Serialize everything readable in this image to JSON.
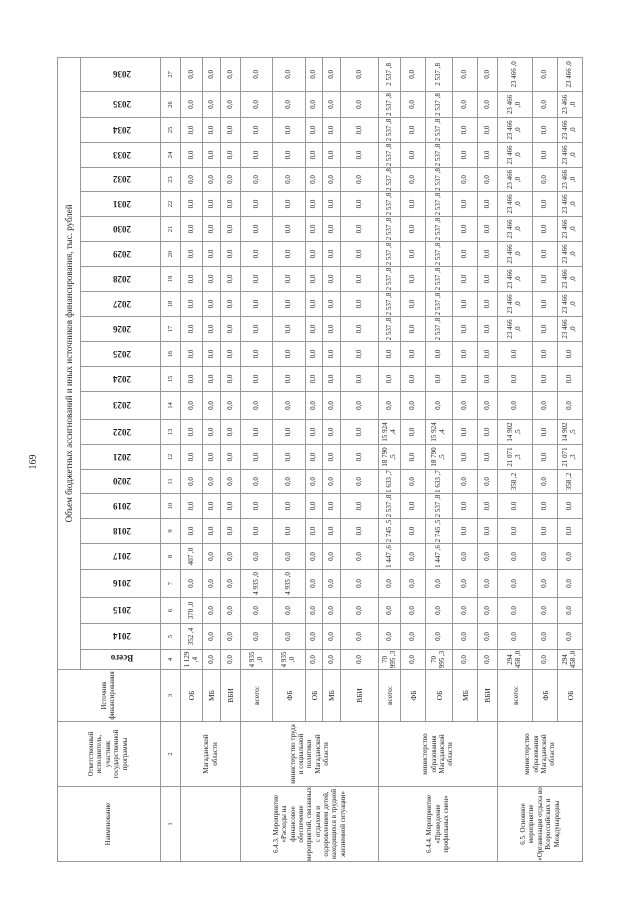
{
  "page": {
    "number": "169"
  },
  "table": {
    "title": "Объем бюджетных ассигнований и иных источников финансирования, тыс. рублей",
    "headers": {
      "name": "Наименование",
      "executor": "Ответственный исполнитель, участник государственной программы",
      "source": "Источник финансирования",
      "total": "Всего"
    },
    "years": [
      "2014",
      "2015",
      "2016",
      "2017",
      "2018",
      "2019",
      "2020",
      "2021",
      "2022",
      "2023",
      "2024",
      "2025",
      "2026",
      "2027",
      "2028",
      "2029",
      "2030",
      "2031",
      "2032",
      "2033",
      "2034",
      "2035",
      "2036"
    ],
    "column_numbers": [
      "1",
      "2",
      "3",
      "4",
      "5",
      "6",
      "7",
      "8",
      "9",
      "10",
      "11",
      "12",
      "13",
      "14",
      "15",
      "16",
      "17",
      "18",
      "19",
      "20",
      "21",
      "22",
      "23",
      "24",
      "25",
      "26",
      "27"
    ],
    "default_value": "0,0",
    "groups": [
      {
        "name": "",
        "executor": "Магаданской области",
        "row_count": 3
      },
      {
        "name": "6.4.3. Мероприятие «Расходы на финансовое обеспечение мероприятий, связанных с отдыхом и оздоровлением детей, находящихся в трудной жизненной ситуации»",
        "executor": "министерство труда и социальной политики Магаданской области",
        "row_count": 5
      },
      {
        "name": "6.4.4. Мероприятие «Проведение профильных смен»",
        "executor": "министерство образования Магаданской области",
        "row_count": 5
      },
      {
        "name": "6.5. Основное мероприятие «Организация отдыха во Всероссийских и Международны",
        "executor": "министерство образования Магаданской области",
        "row_count": 3
      }
    ],
    "rows": [
      {
        "source": "ОБ",
        "total": "1 129 ,4",
        "values": {
          "2014": "352 ,4",
          "2015": "370 ,0",
          "2017": "407 ,0"
        }
      },
      {
        "source": "МБ",
        "total": "0,0",
        "values": {}
      },
      {
        "source": "ВБИ",
        "total": "0,0",
        "values": {}
      },
      {
        "source": "всего:",
        "total": "4 935 ,0",
        "values": {
          "2016": "4 935 ,0"
        }
      },
      {
        "source": "ФБ",
        "total": "4 935 ,0",
        "values": {
          "2016": "4 935 ,0"
        }
      },
      {
        "source": "ОБ",
        "total": "0,0",
        "values": {}
      },
      {
        "source": "МБ",
        "total": "0,0",
        "values": {}
      },
      {
        "source": "ВБИ",
        "total": "0,0",
        "values": {}
      },
      {
        "source": "всего:",
        "total": "70 995 ,3",
        "values": {
          "2017": "1 447 ,6",
          "2018": "2 745 ,5",
          "2019": "2 537 ,8",
          "2020": "1 633 ,7",
          "2021": "18 790 ,5",
          "2022": "15 924 ,4",
          "2026": "2 537 ,8",
          "2027": "2 537 ,8",
          "2028": "2 537 ,8",
          "2029": "2 537 ,8",
          "2030": "2 537 ,8",
          "2031": "2 537 ,8",
          "2032": "2 537 ,8",
          "2033": "2 537 ,8",
          "2034": "2 537 ,8",
          "2035": "2 537 ,8",
          "2036": "2 537 ,8"
        }
      },
      {
        "source": "ФБ",
        "total": "0,0",
        "values": {}
      },
      {
        "source": "ОБ",
        "total": "70 995 ,3",
        "values": {
          "2017": "1 447 ,6",
          "2018": "2 745 ,5",
          "2019": "2 537 ,8",
          "2020": "1 633 ,7",
          "2021": "18 790 ,5",
          "2022": "15 924 ,4",
          "2026": "2 537 ,8",
          "2027": "2 537 ,8",
          "2028": "2 537 ,8",
          "2029": "2 537 ,8",
          "2030": "2 537 ,8",
          "2031": "2 537 ,8",
          "2032": "2 537 ,8",
          "2033": "2 537 ,8",
          "2034": "2 537 ,8",
          "2035": "2 537 ,8",
          "2036": "2 537 ,8"
        }
      },
      {
        "source": "МБ",
        "total": "0,0",
        "values": {}
      },
      {
        "source": "ВБИ",
        "total": "0,0",
        "values": {}
      },
      {
        "source": "всего:",
        "total": "294 458 ,0",
        "values": {
          "2020": "358 ,2",
          "2021": "21 071 ,3",
          "2022": "14 902 ,5",
          "2026": "23 466 ,0",
          "2027": "23 466 ,0",
          "2028": "23 466 ,0",
          "2029": "23 466 ,0",
          "2030": "23 466 ,0",
          "2031": "23 466 ,0",
          "2032": "23 466 ,0",
          "2033": "23 466 ,0",
          "2034": "23 466 ,0",
          "2035": "23 466 ,0",
          "2036": "23 466 ,0"
        }
      },
      {
        "source": "ФБ",
        "total": "0,0",
        "values": {}
      },
      {
        "source": "ОБ",
        "total": "294 458 ,0",
        "values": {
          "2020": "358 ,2",
          "2021": "21 071 ,3",
          "2022": "14 902 ,5",
          "2026": "23 466 ,0",
          "2027": "23 466 ,0",
          "2028": "23 466 ,0",
          "2029": "23 466 ,0",
          "2030": "23 466 ,0",
          "2031": "23 466 ,0",
          "2032": "23 466 ,0",
          "2033": "23 466 ,0",
          "2034": "23 466 ,0",
          "2035": "23 466 ,0",
          "2036": "23 466 ,0"
        }
      }
    ]
  }
}
